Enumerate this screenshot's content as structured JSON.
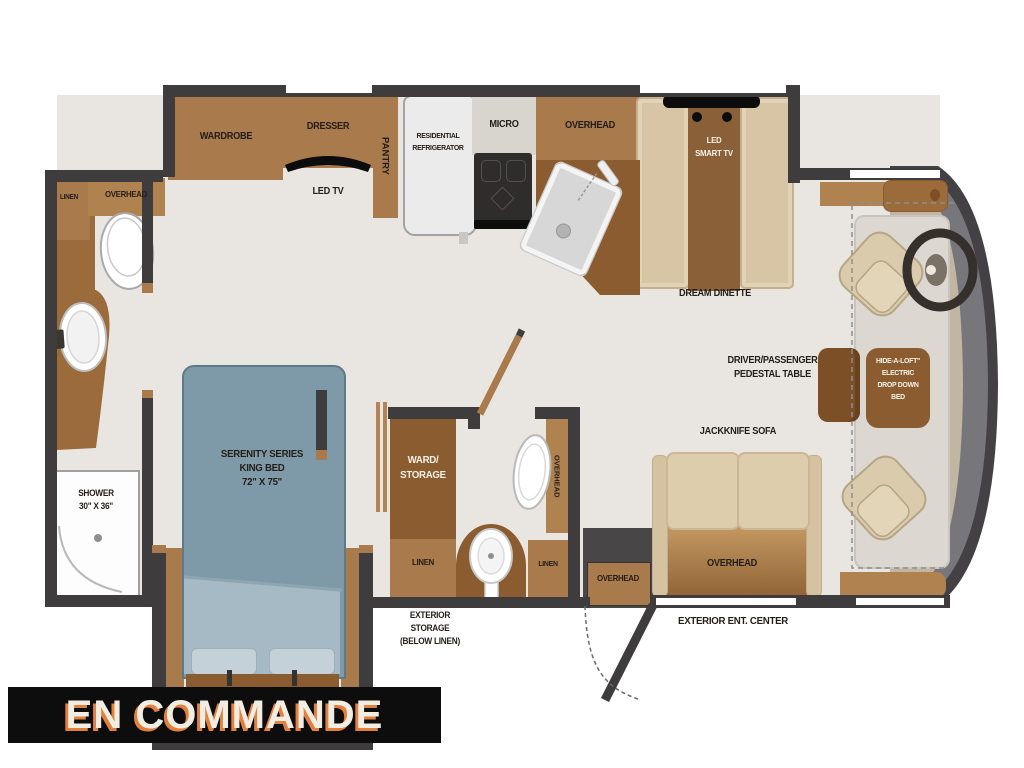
{
  "banner": {
    "status": "EN COMMANDE"
  },
  "colors": {
    "wall": "#3e3c3c",
    "floor": "#e9e6e1",
    "cabinet": "#a87a4c",
    "cabinet_dark": "#8a5c30",
    "bed_blue": "#7e9aa9",
    "seat_beige": "#dcceae",
    "cab_gray": "#77767b",
    "banner_bg": "#0d0d0d",
    "banner_text": "#f2ede3",
    "banner_shadow": "#e2813c"
  },
  "bedroom": {
    "wardrobe": "WARDROBE",
    "dresser": "DRESSER",
    "pantry": "PANTRY",
    "led_tv": "LED TV",
    "bed_name_1": "SERENITY SERIES",
    "bed_name_2": "KING BED",
    "bed_size": "72\" X 75\""
  },
  "bath_rear": {
    "linen": "LINEN",
    "overhead": "OVERHEAD",
    "shower": "SHOWER",
    "shower_size": "30\" X 36\""
  },
  "kitchen": {
    "fridge_1": "RESIDENTIAL",
    "fridge_2": "REFRIGERATOR",
    "micro": "MICRO",
    "overhead": "OVERHEAD"
  },
  "dinette": {
    "tv_1": "LED",
    "tv_2": "SMART TV",
    "name": "DREAM DINETTE"
  },
  "bath_mid": {
    "ward_1": "WARD/",
    "ward_2": "STORAGE",
    "linen_left": "LINEN",
    "linen_right": "LINEN",
    "overhead": "OVERHEAD",
    "ext_storage_1": "EXTERIOR",
    "ext_storage_2": "STORAGE",
    "ext_storage_3": "(BELOW LINEN)"
  },
  "living": {
    "sofa": "JACKKNIFE SOFA",
    "sofa_overhead": "OVERHEAD",
    "entry_overhead": "OVERHEAD",
    "ent_center": "EXTERIOR ENT. CENTER",
    "ped_table_1": "DRIVER/PASSENGER",
    "ped_table_2": "PEDESTAL TABLE"
  },
  "cab": {
    "loft_1": "HIDE-A-LOFT\"",
    "loft_2": "ELECTRIC",
    "loft_3": "DROP DOWN",
    "loft_4": "BED"
  }
}
